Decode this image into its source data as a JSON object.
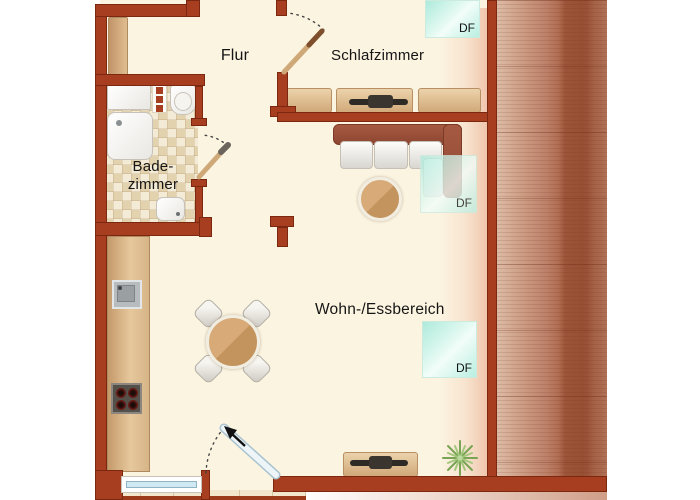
{
  "rooms": {
    "hallway": {
      "label": "Flur"
    },
    "bedroom": {
      "label": "Schlafzimmer"
    },
    "bathroom": {
      "line1": "Bade-",
      "line2": "zimmer"
    },
    "living_dining": {
      "label": "Wohn-/Essbereich"
    }
  },
  "skylights": {
    "bedroom": {
      "label": "DF"
    },
    "living_upper": {
      "label": "DF"
    },
    "living_lower": {
      "label": "DF"
    }
  },
  "colors": {
    "wall": "#a63e1f",
    "wall_outline": "#7c2810",
    "floor": "#fbf4e1",
    "roof_light": "#ddbba7",
    "roof_dark": "#a25d41",
    "skylight_teal": "#b9efe1",
    "furniture_tan": "#d8b285",
    "sofa_brown": "#9a5038",
    "table_wood": "#c99a66",
    "glass_blue": "#cfe8f2",
    "plant_green": "#79a355",
    "background": "#ffffff"
  }
}
